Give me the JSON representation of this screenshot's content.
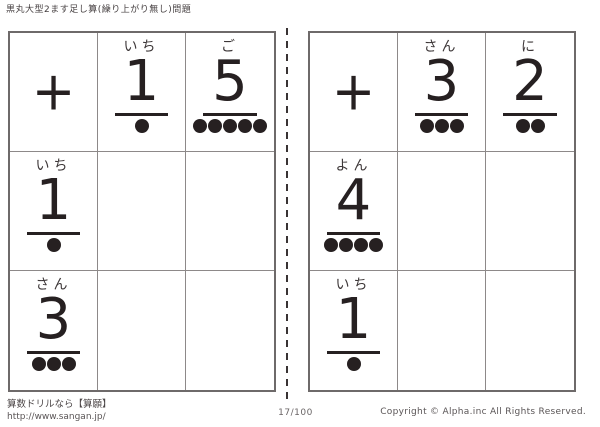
{
  "page": {
    "title": "黒丸大型2ます足し算(繰り上がり無し)問題"
  },
  "colors": {
    "ink": "#262021",
    "grid_line": "#8d8989",
    "label": "#3d3738"
  },
  "tables": [
    {
      "side": "left",
      "operator": "+",
      "col_headers": [
        {
          "label": "いち",
          "digit": "1",
          "dots": 1
        },
        {
          "label": "ご",
          "digit": "5",
          "dots": 5
        }
      ],
      "row_headers": [
        {
          "label": "いち",
          "digit": "1",
          "dots": 1
        },
        {
          "label": "さん",
          "digit": "3",
          "dots": 3
        }
      ]
    },
    {
      "side": "right",
      "operator": "+",
      "col_headers": [
        {
          "label": "さん",
          "digit": "3",
          "dots": 3
        },
        {
          "label": "に",
          "digit": "2",
          "dots": 2
        }
      ],
      "row_headers": [
        {
          "label": "よん",
          "digit": "4",
          "dots": 4
        },
        {
          "label": "いち",
          "digit": "1",
          "dots": 1
        }
      ]
    }
  ],
  "footer": {
    "site_line": "算数ドリルなら【算願】",
    "site_url": "http://www.sangan.jp/",
    "page_number": "17/100",
    "copyright": "Copyright © Alpha.inc All Rights Reserved."
  }
}
